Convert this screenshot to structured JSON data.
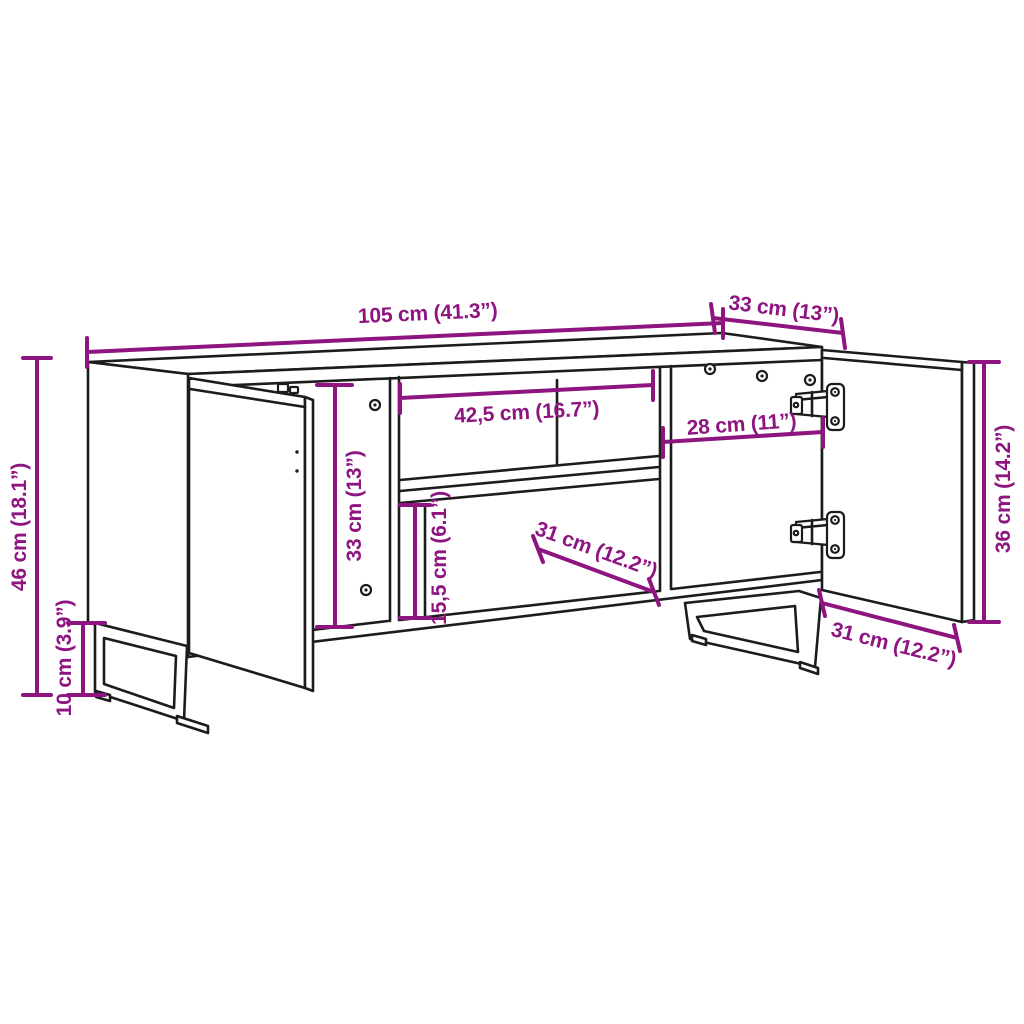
{
  "diagram": {
    "subject": "TV cabinet dimension drawing with open doors, middle shelf and metal sled legs",
    "style": {
      "background": "#ffffff",
      "outline_color": "#1c1c1c",
      "dimension_color": "#8E1480"
    },
    "dimensions": {
      "overall_width": "105 cm (41.3”)",
      "overall_depth": "33 cm (13”)",
      "overall_height": "46 cm (18.1”)",
      "leg_height": "10 cm (3.9”)",
      "interior_height": "33 cm (13”)",
      "middle_compartment_width": "42,5 cm (16.7”)",
      "right_compartment_width": "28 cm (11”)",
      "lower_compartment_height": "15,5 cm (6.1”)",
      "shelf_depth": "31 cm (12.2”)",
      "door_height": "36 cm (14.2”)",
      "door_width": "31 cm (12.2”)"
    }
  }
}
